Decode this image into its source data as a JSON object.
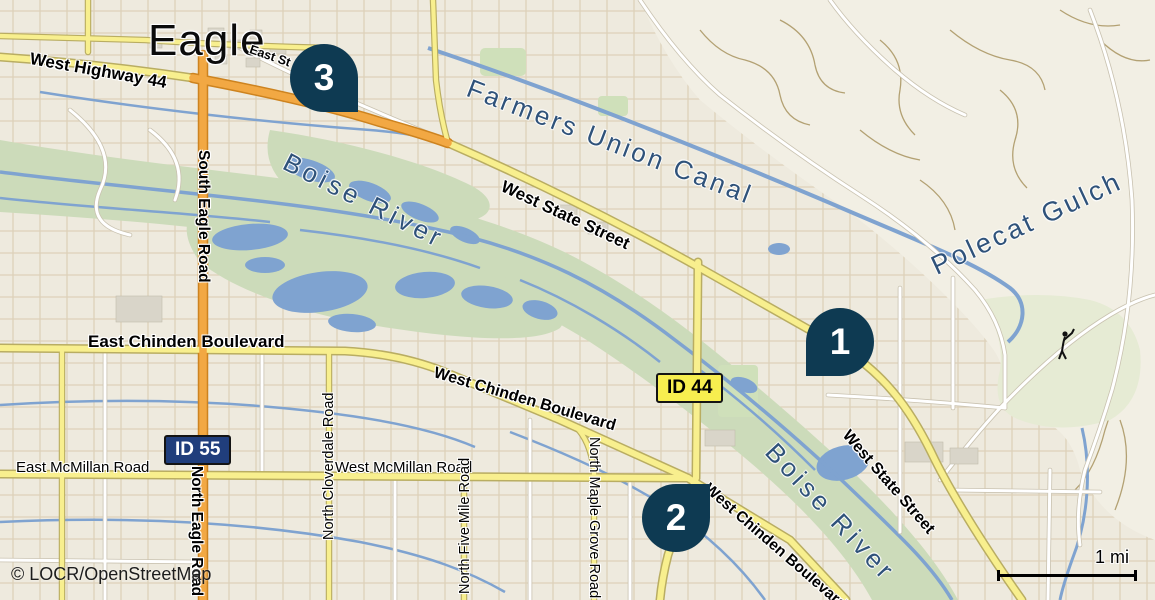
{
  "colors": {
    "marker": "#0e3a52",
    "marker-text": "#ffffff",
    "water": "#7fa3d0",
    "water-label": "#2f527a",
    "land": "#eeeade",
    "hills": "#f2efe4",
    "greenspace": "#ccdbba",
    "park": "#cfe0ba",
    "golf": "#e6ebd4",
    "road-yellow": "#f8ef8e",
    "road-yellow-casing": "#b9ad62",
    "road-orange": "#f2a843",
    "road-orange-casing": "#cd831f",
    "road-white": "#ffffff",
    "road-white-casing": "#c9c2b0",
    "street-grid": "#dacdb3",
    "trail": "#b3a173",
    "building": "#d9d5c9",
    "label": "#000000",
    "shield-id44-bg": "#f7ee4f",
    "shield-id44-text": "#000000",
    "shield-id55-bg": "#203e7c",
    "shield-id55-text": "#ffffff"
  },
  "city": {
    "name": "Eagle"
  },
  "markers": [
    {
      "number": "1"
    },
    {
      "number": "2"
    },
    {
      "number": "3"
    }
  ],
  "shields": {
    "id44": "ID 44",
    "id55": "ID 55"
  },
  "roads": {
    "west_highway_44": "West Highway 44",
    "east_st": "East St",
    "west_state_street_upper": "West State Street",
    "west_state_street_lower": "West State Street",
    "east_chinden_boulevard": "East Chinden Boulevard",
    "west_chinden_boulevard_upper": "West Chinden Boulevard",
    "west_chinden_boulevard_lower": "West Chinden Boulevard",
    "south_eagle_road": "South Eagle Road",
    "north_eagle_road": "North Eagle Road",
    "east_mcmillan_road": "East McMillan Road",
    "west_mcmillan_road": "West McMillan Road",
    "north_cloverdale_road": "North Cloverdale Road",
    "north_five_mile_road": "North Five Mile Road",
    "north_maple_grove_road": "North Maple Grove Road"
  },
  "water": {
    "farmers_union_canal": "Farmers Union Canal",
    "boise_river_west": "Boise River",
    "boise_river_east": "Boise River",
    "polecat_gulch": "Polecat Gulch"
  },
  "scale": {
    "label": "1 mi"
  },
  "attribution": {
    "text": "© LOCR/OpenStreetMap"
  }
}
